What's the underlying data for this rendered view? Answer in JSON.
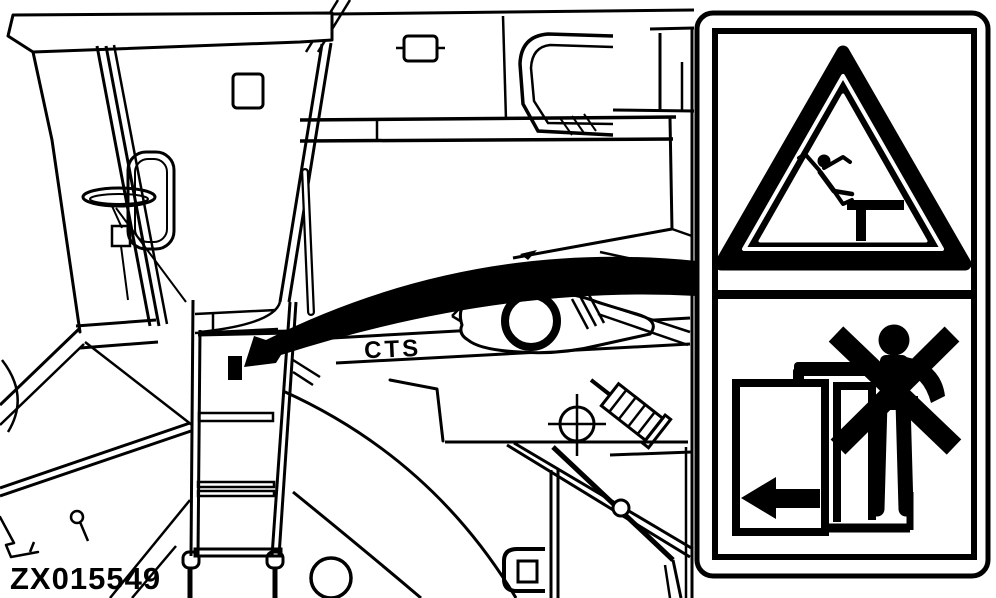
{
  "figure": {
    "machine_label": "CTS",
    "image_code": "ZX015549",
    "description": "Combine harvester left side at operator cab and access ladder; callout arrow shows safety decal mounting location"
  },
  "callout": {
    "arrow": "curved-callout-arrow",
    "marker": "decal-location-marker"
  },
  "decal": {
    "top_symbol": "warning-triangle-falling-person-icon",
    "bottom_symbol": "no-riding-on-moving-ladder-icon",
    "arrow_symbol": "left-arrow-icon",
    "foreground_color": "#000000",
    "background_color": "#ffffff"
  }
}
